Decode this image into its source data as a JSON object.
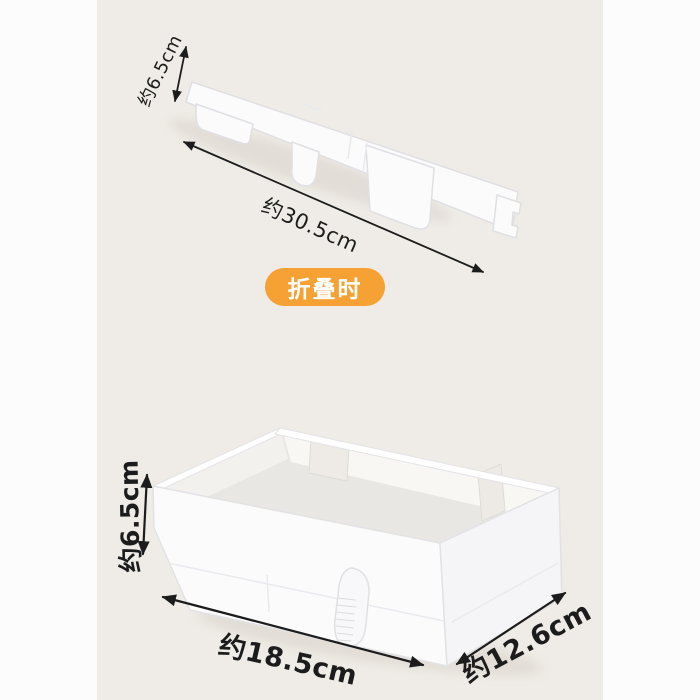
{
  "canvas": {
    "background": "#fcfcfc",
    "panel_background": "#efece7"
  },
  "colors": {
    "accent_orange": "#f5a133",
    "annotation_text": "#1c1c1c",
    "product_white": "#fbfbfc"
  },
  "folded_view": {
    "badge_label": "折叠时",
    "height_label": "约6.5cm",
    "length_label": "约30.5cm"
  },
  "unfolded_view": {
    "height_label": "约6.5cm",
    "width_label": "约18.5cm",
    "depth_label": "约12.6cm"
  }
}
